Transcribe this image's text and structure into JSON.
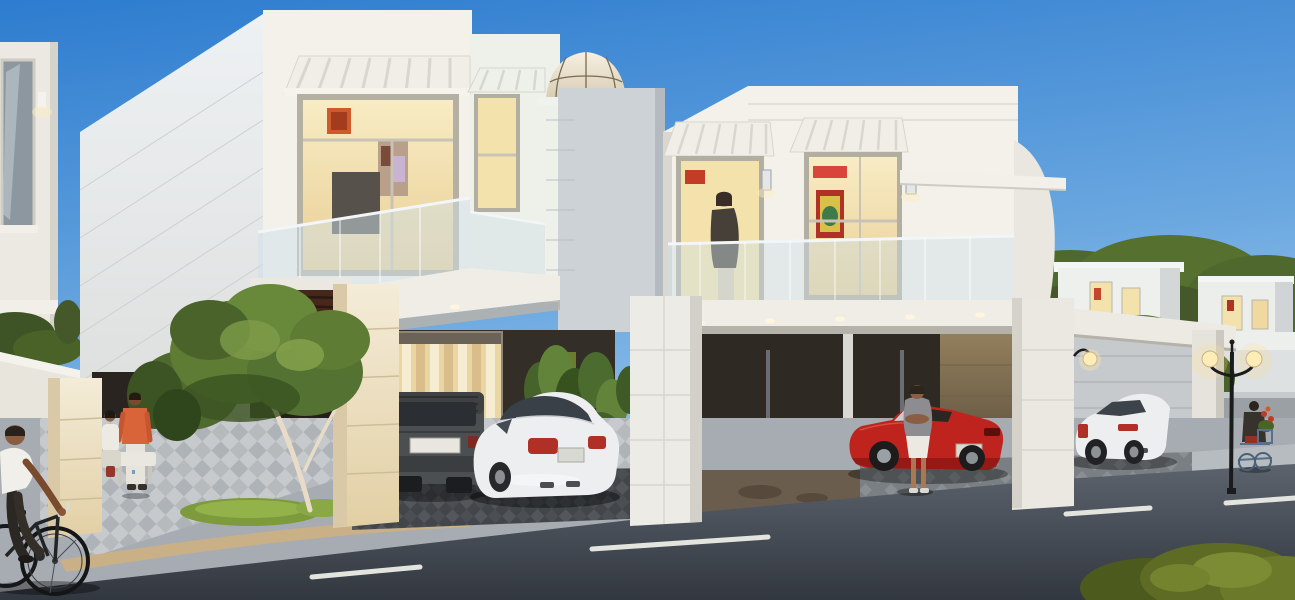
{
  "scene": {
    "type": "architectural-rendering",
    "description": "Modern white two-storey villas at dusk with warmly lit interiors, a glass dome skylight, carports with parked cars, landscaped sidewalk with ornamental tree, asphalt street with dashed lane markings, a cyclist and pedestrians",
    "time_of_day": "dusk",
    "vehicles": [
      "dark gray SUV",
      "white sedan in left carport",
      "red convertible in right carport",
      "white sedan in far right carport"
    ],
    "people": [
      "cyclist in white shirt",
      "man in orange shirt",
      "seated woman with red bag",
      "woman standing by red convertible",
      "person standing at lit balcony window",
      "vendor with flower cart"
    ],
    "lighting": [
      "double-globe street lamp",
      "column wall lamp",
      "bollard path light",
      "interior warm window glow",
      "balcony downlights"
    ],
    "landscape": [
      "ornamental tree on grass patch",
      "green wall plants",
      "background tree line",
      "corner hedge bush"
    ]
  },
  "palette": {
    "sky_top": "#2d7ccf",
    "sky_horizon": "#abd1ee",
    "wall_white": "#f3f1ea",
    "wall_side": "#e7ebee",
    "wall_shadow": "#cdd2d6",
    "wall_cream": "#ead9b6",
    "window_glow": "#f4e2ac",
    "glass_rail": "#cfdfe7",
    "wood_dark": "#46281a",
    "road": "#5c636d",
    "road_dash": "#e3e4de",
    "sidewalk": "#c6cacd",
    "curb_tan": "#c9b087",
    "grass": "#7d9a3c",
    "tree": "#5e7c33",
    "car_gray": "#4c4f52",
    "car_white": "#eceef0",
    "car_red": "#bf231d",
    "taillight": "#b03028",
    "lamp_glow": "#ffedb8",
    "lamp_pole": "#1a1b1d",
    "shirt_orange": "#d9643a",
    "shirt_white": "#f1efe9"
  }
}
